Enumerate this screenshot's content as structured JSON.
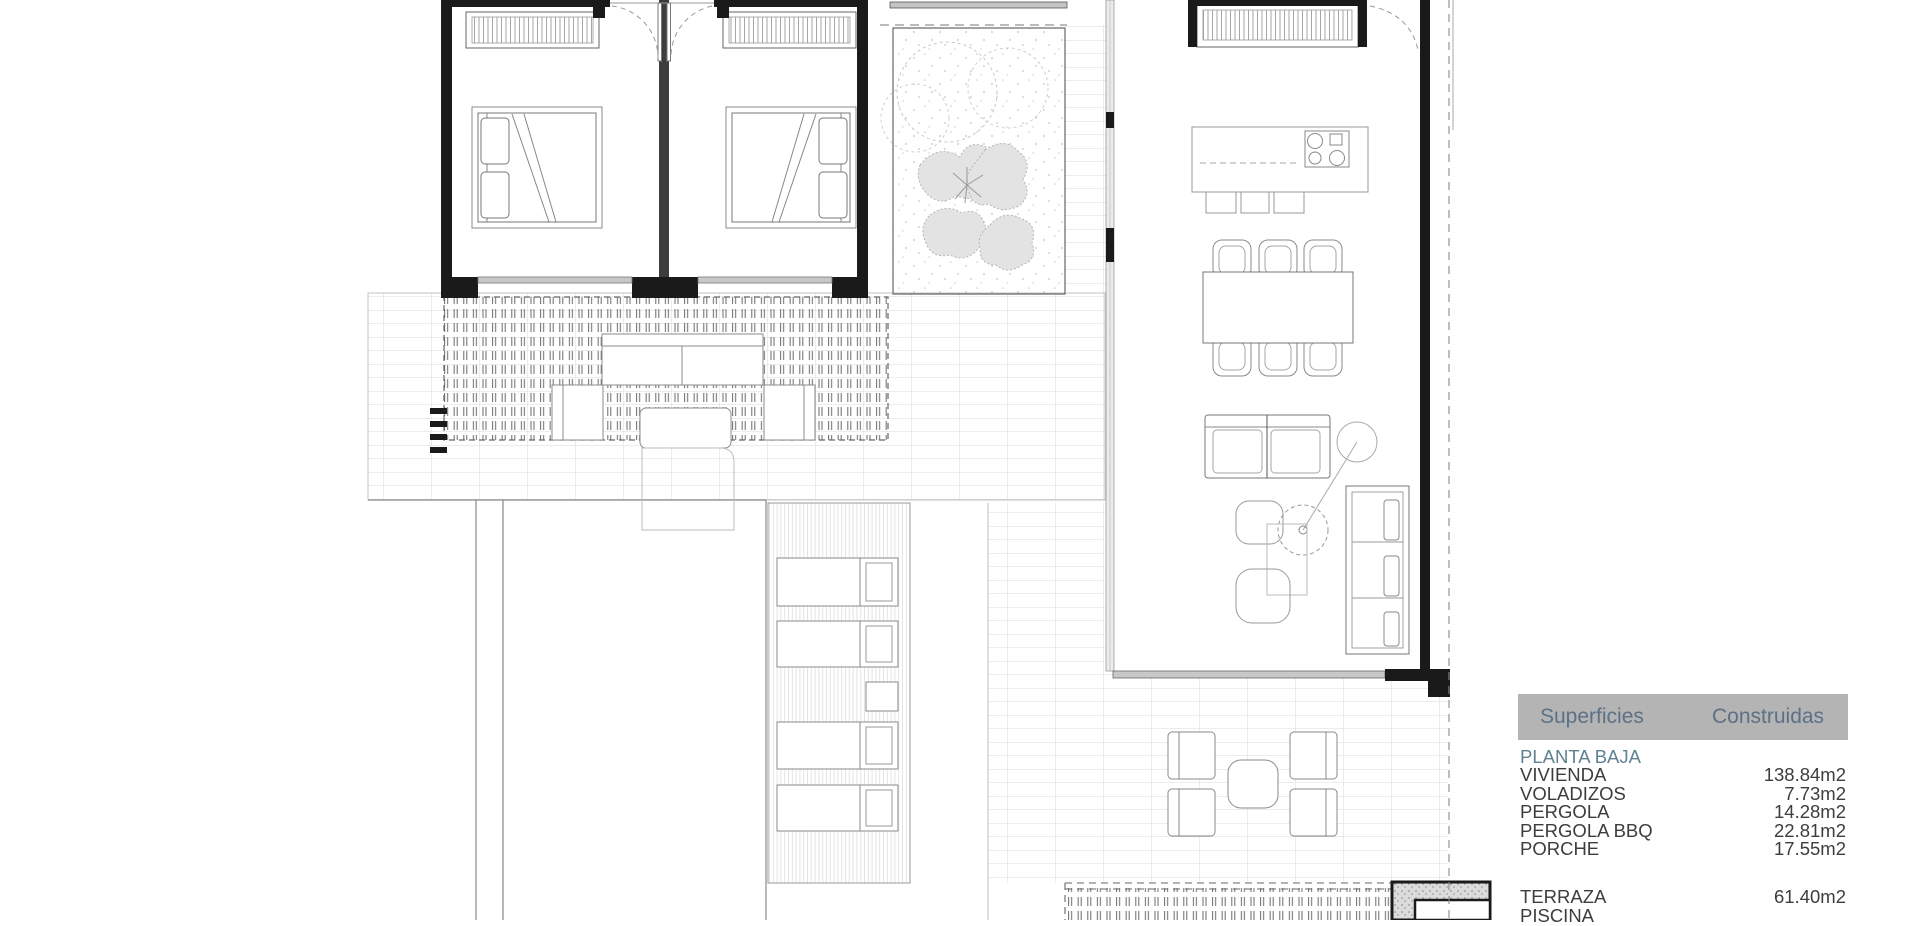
{
  "legend": {
    "header": {
      "col1": "Superficies",
      "col2": "Construidas"
    },
    "section_title": "PLANTA BAJA",
    "rows": [
      {
        "label": "VIVIENDA",
        "value": "138.84m2"
      },
      {
        "label": "VOLADIZOS",
        "value": "7.73m2"
      },
      {
        "label": "PERGOLA",
        "value": "14.28m2"
      },
      {
        "label": "PERGOLA BBQ",
        "value": "22.81m2"
      },
      {
        "label": "PORCHE",
        "value": "17.55m2"
      }
    ],
    "exterior_rows": [
      {
        "label": "TERRAZA",
        "value": "61.40m2"
      },
      {
        "label": "PISCINA",
        "value": ""
      }
    ],
    "colors": {
      "header_bg": "#b4b4b4",
      "header_text": "#5d7186",
      "section_text": "#5f8191",
      "row_text": "#3d3d3d"
    }
  }
}
